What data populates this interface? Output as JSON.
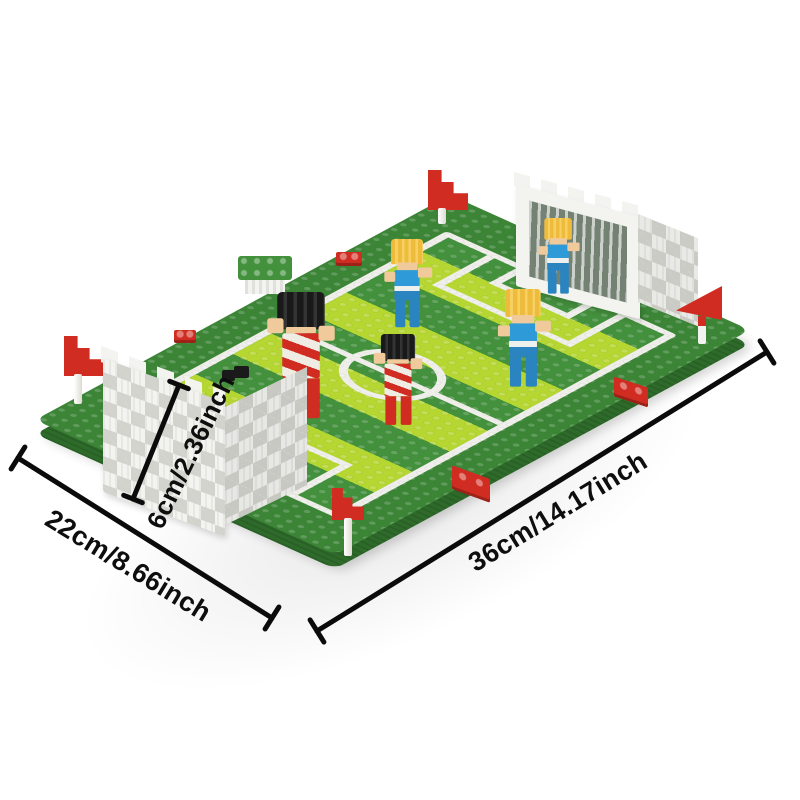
{
  "product": {
    "name": "micro-brick-football-field-model"
  },
  "annotations": {
    "width": {
      "label": "22cm/8.66inch"
    },
    "length": {
      "label": "36cm/14.17inch"
    },
    "height": {
      "label": "6cm/2.36inch"
    }
  },
  "colors": {
    "line": "#0b0b0b",
    "base_green": "#3c8537",
    "base_side": "#2e6b2a",
    "stripe_light": "#b6d631",
    "stripe_dark": "#43903d",
    "white_line": "#efeeea",
    "goal_white": "#f3f3f0",
    "goal_hole": "#d3d3cd",
    "team_red": "#d02c21",
    "team_blue": "#2f9ad8",
    "skin": "#f0ca9b",
    "hair_black": "#191919",
    "hair_gold": "#eebb3c"
  },
  "scene": {
    "parts": [
      "pitch-baseplate",
      "goal-left",
      "goal-right",
      "player-red-1",
      "player-red-2",
      "player-blue-1",
      "player-blue-2",
      "player-blue-3",
      "corner-flag-west",
      "corner-flag-north",
      "corner-flag-south",
      "corner-flag-east",
      "bench-block",
      "ball-bricks",
      "red-marker-plates"
    ]
  }
}
